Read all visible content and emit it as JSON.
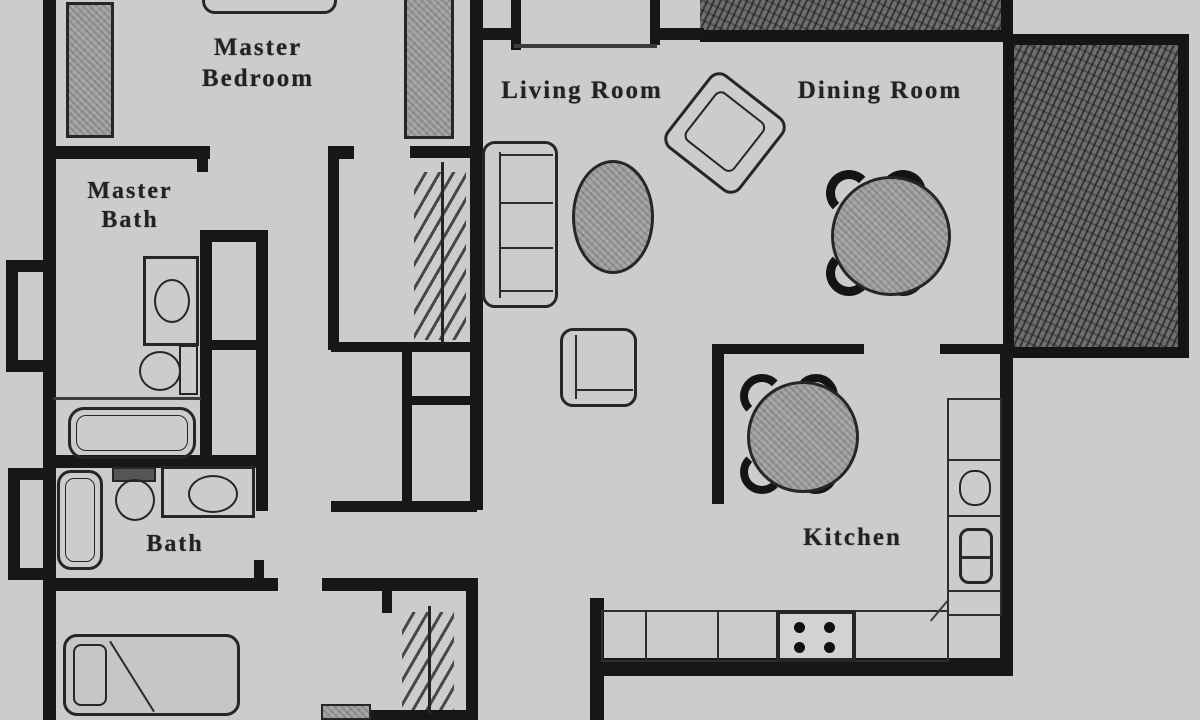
{
  "rooms": {
    "master_bedroom": {
      "label": "Master\nBedroom"
    },
    "master_bath": {
      "label": "Master\nBath"
    },
    "bath": {
      "label": "Bath"
    },
    "living_room": {
      "label": "Living Room"
    },
    "dining_room": {
      "label": "Dining Room"
    },
    "kitchen": {
      "label": "Kitchen"
    }
  },
  "symbols": {
    "furniture": [
      "bed",
      "pillow",
      "dresser",
      "sofa",
      "coffee-table",
      "armchair",
      "end-table",
      "round-dining-table-with-4-chairs",
      "round-kitchen-table-with-4-chairs",
      "stove-4-burners",
      "double-sink",
      "sink-oval",
      "vanity",
      "toilet",
      "bathtub",
      "closet-rod-with-hangers",
      "kitchen-counter"
    ],
    "outdoor": [
      "hatched-balcony-strip",
      "hatched-patio-block"
    ]
  },
  "colors": {
    "wall": "#171717",
    "floor": "#cccccc",
    "furniture_fill": "#a2a2a2",
    "patio_fill": "#6e6e6e",
    "label_text": "#222222"
  }
}
